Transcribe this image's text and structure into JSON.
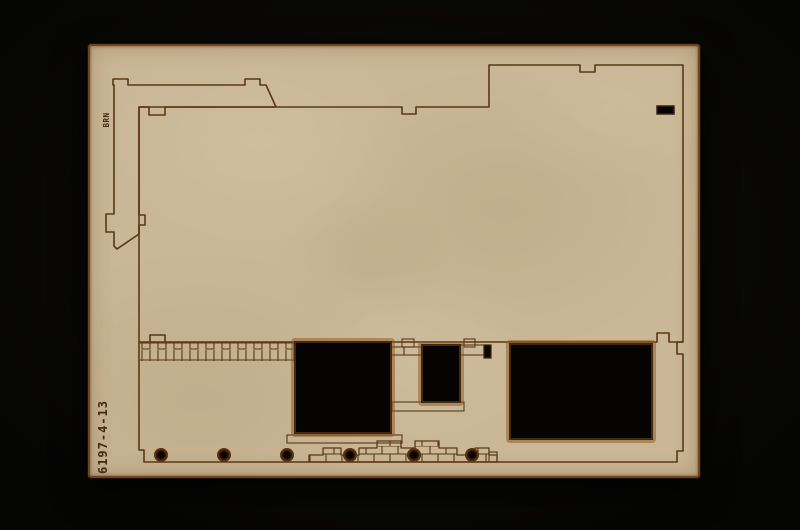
{
  "scene": {
    "description": "Photograph of a tan laser-cut MDF model kit sheet (building wall panel with window cut-outs, etched brick courses and registration holes) on a black background"
  },
  "colors": {
    "bg": "#040404",
    "board": "#c9b795",
    "burn": "#6e441c",
    "etch": "#5a3815",
    "cut": "#2e1a08",
    "text": "#43290e"
  },
  "labels": {
    "part_number": "6197-4-13",
    "corner_mark": "BRN"
  }
}
